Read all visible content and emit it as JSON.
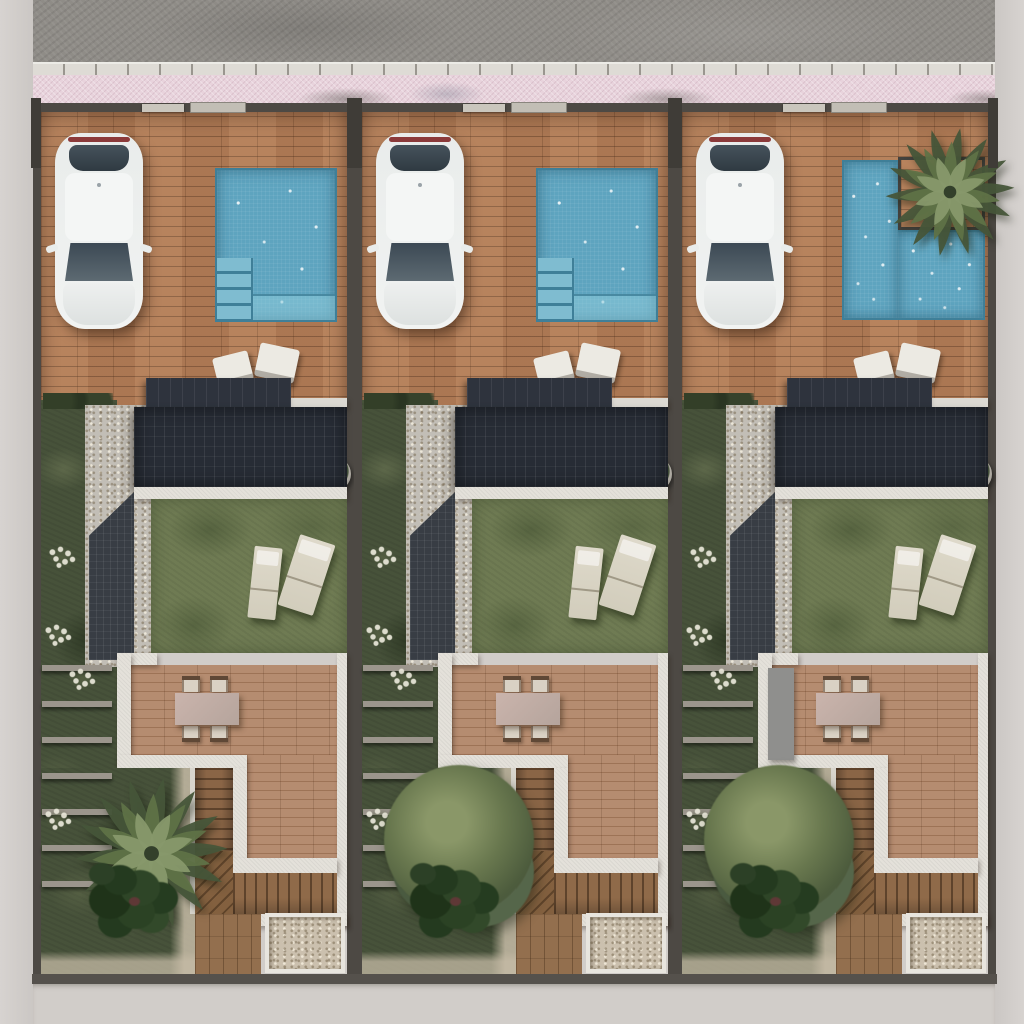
{
  "scene": {
    "type": "aerial-top-down-architectural-render",
    "description": "Top-down 3D render of three identical attached villa plots. Each plot has a brick driveway terrace with a parked white car, a private swimming pool, a dark solar-panel roof block, a walled lawn courtyard with two sun loungers, a wooden dining deck with a table for four, an L-shaped wooden staircase, gravel patches and lush rear gardens. A gray asphalt road, white curb and pink paved sidewalk run along the top; light concrete ground frames the sides and bottom.",
    "streetscape": {
      "road": "asphalt road",
      "curb": "white concrete curb with joints",
      "sidewalk": "pink paved sidewalk",
      "margins": "light concrete ground"
    },
    "units": [
      {
        "id": "villa-plot-1",
        "position": "left",
        "car": "white car parked nose-in on brick driveway",
        "pool_shape": "rectangular",
        "pool_has_corner_steps": true,
        "planter_palm_at_pool": false,
        "terrace_chairs": 2,
        "potted_plants": 1,
        "solar_roof": true,
        "pergola": true,
        "loungers": 2,
        "dining_chairs": 4,
        "rear_tree": "palm",
        "concrete_wall_element": false,
        "gravel_patch": true,
        "staircase": "L-shaped wooden stairs"
      },
      {
        "id": "villa-plot-2",
        "position": "middle",
        "car": "white car parked nose-in on brick driveway",
        "pool_shape": "rectangular",
        "pool_has_corner_steps": true,
        "planter_palm_at_pool": false,
        "terrace_chairs": 2,
        "potted_plants": 1,
        "solar_roof": true,
        "pergola": true,
        "loungers": 2,
        "dining_chairs": 4,
        "rear_tree": "leafy",
        "concrete_wall_element": false,
        "gravel_patch": true,
        "staircase": "L-shaped wooden stairs"
      },
      {
        "id": "villa-plot-3",
        "position": "right",
        "car": "white car parked nose-in on brick driveway",
        "pool_shape": "l-shaped",
        "pool_has_corner_steps": false,
        "planter_palm_at_pool": true,
        "terrace_chairs": 2,
        "potted_plants": 1,
        "solar_roof": true,
        "pergola": true,
        "loungers": 2,
        "dining_chairs": 4,
        "rear_tree": "leafy",
        "concrete_wall_element": true,
        "gravel_patch": true,
        "staircase": "L-shaped wooden stairs"
      }
    ],
    "palette": {
      "ground": "#d1cdc9",
      "road": "#8f8c87",
      "curb": "#dedbd5",
      "sidewalk": "#e8d3dc",
      "darkwall": "#4d4944",
      "brick": "#a3714f",
      "bricklight": "#b37e58",
      "brickdark": "#8a5f41",
      "pool": "#5ea4bf",
      "pooldark": "#3f7f98",
      "poollight": "#7fbcd0",
      "roof": "#272c35",
      "pergola": "#383d44",
      "lawn": "#6f7b53",
      "garden": "#47523a",
      "wooddeck": "#ad8164",
      "woodstair": "#8a6546",
      "whitewall": "#e4e1da",
      "gravel": "#cbc0ae",
      "gravelcourt": "#c2beb6",
      "tabletop": "#b5a49c",
      "chair": "#d9d1c4",
      "lounger": "#ded9ca",
      "taillight": "#8c3a3a",
      "grayel": "#8f8f8d",
      "bars": "#9b958c",
      "flower": "#e6e4d6",
      "planterline": "#44423e",
      "palmdark": "#465539",
      "palmmid": "#5f7247",
      "palmlight": "#87986b",
      "foliage": "#2c4026"
    }
  }
}
